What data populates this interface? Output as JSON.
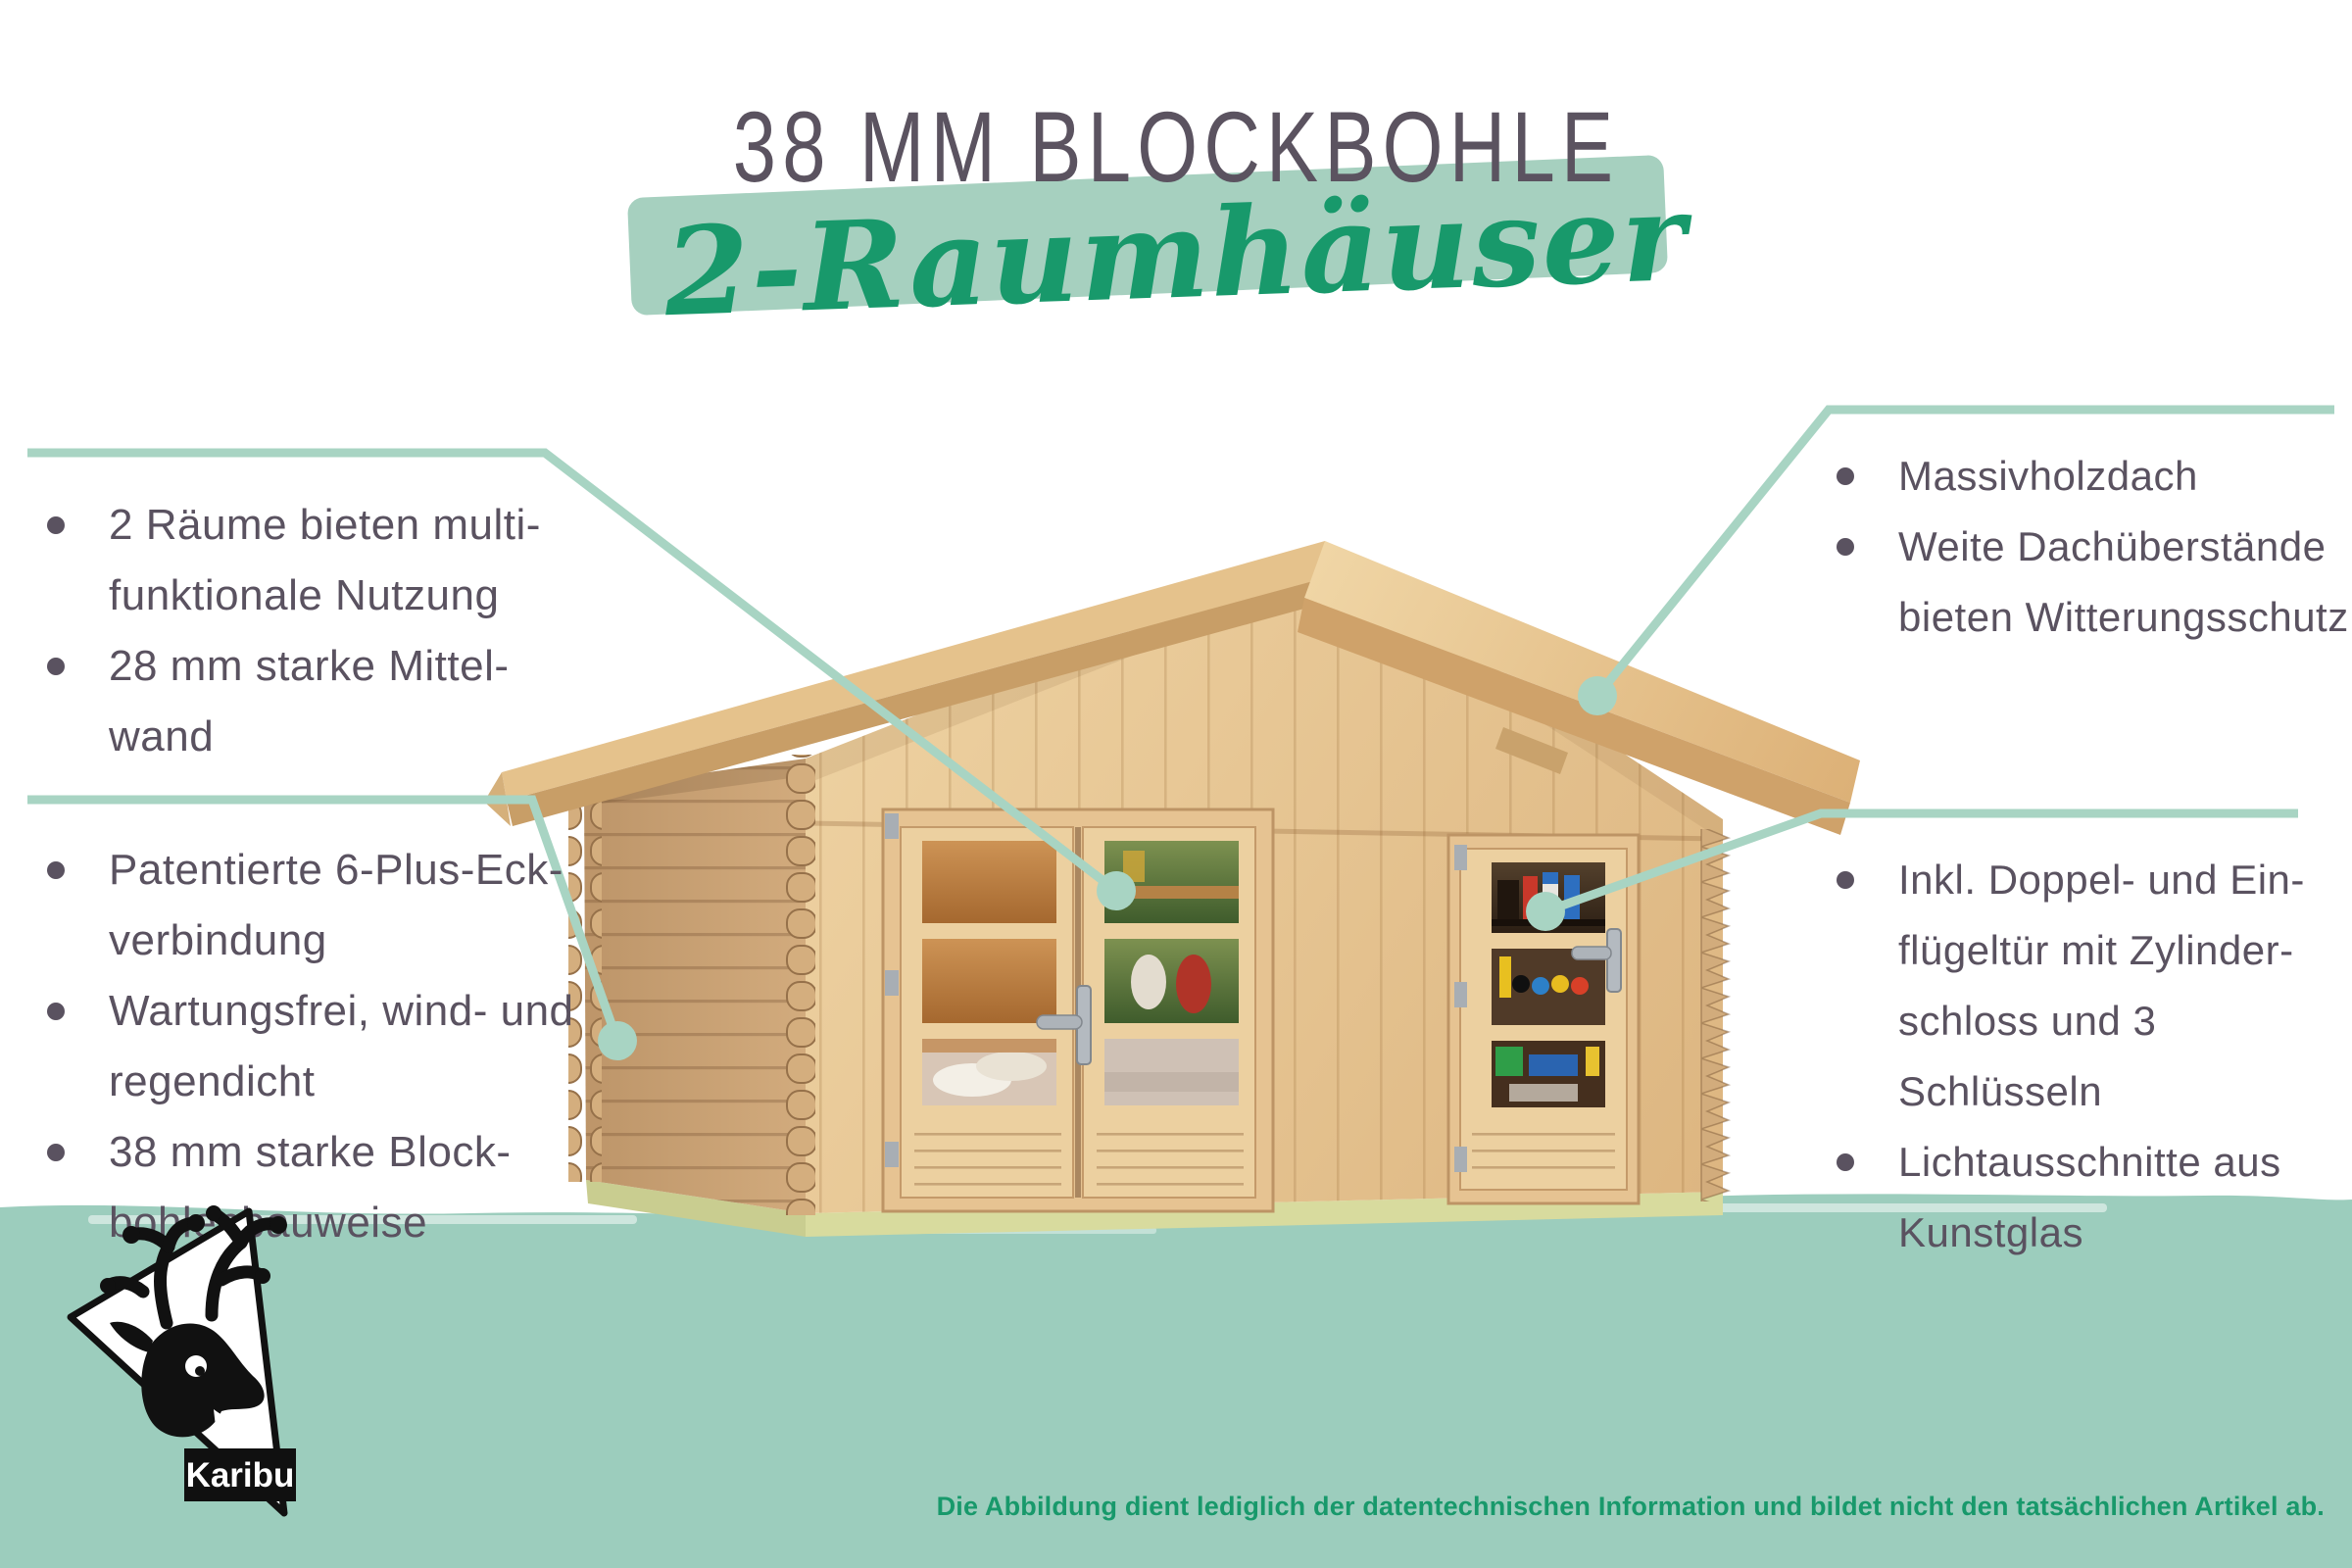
{
  "title": "38 MM BLOCKBOHLE",
  "subtitle": "2-Raumhäuser",
  "callouts": {
    "top_left": {
      "items": [
        [
          "2 Räume bieten multi-",
          "funktionale Nutzung"
        ],
        [
          "28 mm starke Mittel-",
          "wand"
        ]
      ]
    },
    "bottom_left": {
      "items": [
        [
          "Patentierte 6-Plus-Eck-",
          "verbindung"
        ],
        [
          "Wartungsfrei, wind- und",
          "regendicht"
        ],
        [
          "38 mm starke Block-",
          "bohlenbauweise"
        ]
      ]
    },
    "top_right": {
      "items": [
        [
          "Massivholzdach"
        ],
        [
          "Weite Dachüberstände",
          "bieten Witterungsschutz"
        ]
      ]
    },
    "bottom_right": {
      "items": [
        [
          "Inkl. Doppel- und Ein-",
          "flügeltür mit Zylinder-",
          "schloss und 3",
          "Schlüsseln"
        ],
        [
          "Lichtausschnitte aus",
          "Kunstglas"
        ]
      ]
    }
  },
  "logo": {
    "brand": "Karibu"
  },
  "footer": {
    "disclaimer": "Die Abbildung dient lediglich der datentechnischen Information und bildet nicht den tatsächlichen Artikel ab."
  },
  "colors": {
    "accent_mint": "#a8d4c3",
    "band_mint": "#9ccdbd",
    "brush_mint": "#a6d0bf",
    "brand_green": "#18996b",
    "heading_gray": "#5b5360",
    "body_text": "#5a5260"
  }
}
